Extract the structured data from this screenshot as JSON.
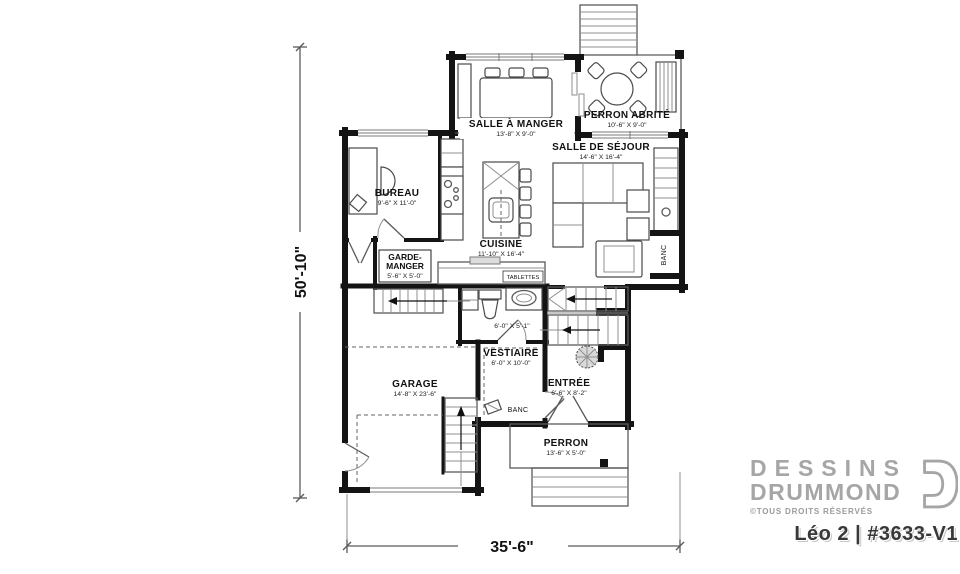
{
  "plan_dimensions": {
    "width_total": "35'-6\"",
    "height_total": "50'-10\""
  },
  "rooms": {
    "salle_a_manger": {
      "name": "SALLE À MANGER",
      "dims": "13'-8\" X 9'-0\""
    },
    "perron_abrite": {
      "name": "PERRON ABRITÉ",
      "dims": "10'-6\" X 9'-0\""
    },
    "salle_de_sejour": {
      "name": "SALLE DE SÉJOUR",
      "dims": "14'-6\" X 16'-4\""
    },
    "bureau": {
      "name": "BUREAU",
      "dims": "9'-6\" X 11'-0\""
    },
    "cuisine": {
      "name": "CUISINE",
      "dims": "11'-10\" X 16'-4\""
    },
    "garde_manger": {
      "name_line1": "GARDE-",
      "name_line2": "MANGER",
      "dims": "5'-6\" X 5'-0\""
    },
    "salle_eau": {
      "dims": "6'-0\" X 5'-1\""
    },
    "vestiaire": {
      "name": "VESTIAIRE",
      "dims": "6'-0\" X 10'-0\""
    },
    "entree": {
      "name": "ENTRÉE",
      "dims": "6'-6\" X 8'-2\""
    },
    "garage": {
      "name": "GARAGE",
      "dims": "14'-8\" X 23'-6\""
    },
    "perron": {
      "name": "PERRON",
      "dims": "13'-6\" X 5'-0\""
    }
  },
  "annotations": {
    "tablettes": "TABLETTES",
    "banc_sejour": "BANC",
    "banc_vestiaire": "BANC"
  },
  "branding": {
    "logo_line1": "DESSINS",
    "logo_line2": "DRUMMOND",
    "rights": "©TOUS DROITS RÉSERVÉS",
    "plan_number": "Léo 2 | #3633-V1"
  },
  "colors": {
    "wall": "#141414",
    "logo_gray": "#a6a6a6",
    "line_gray": "#5a5a5a"
  }
}
